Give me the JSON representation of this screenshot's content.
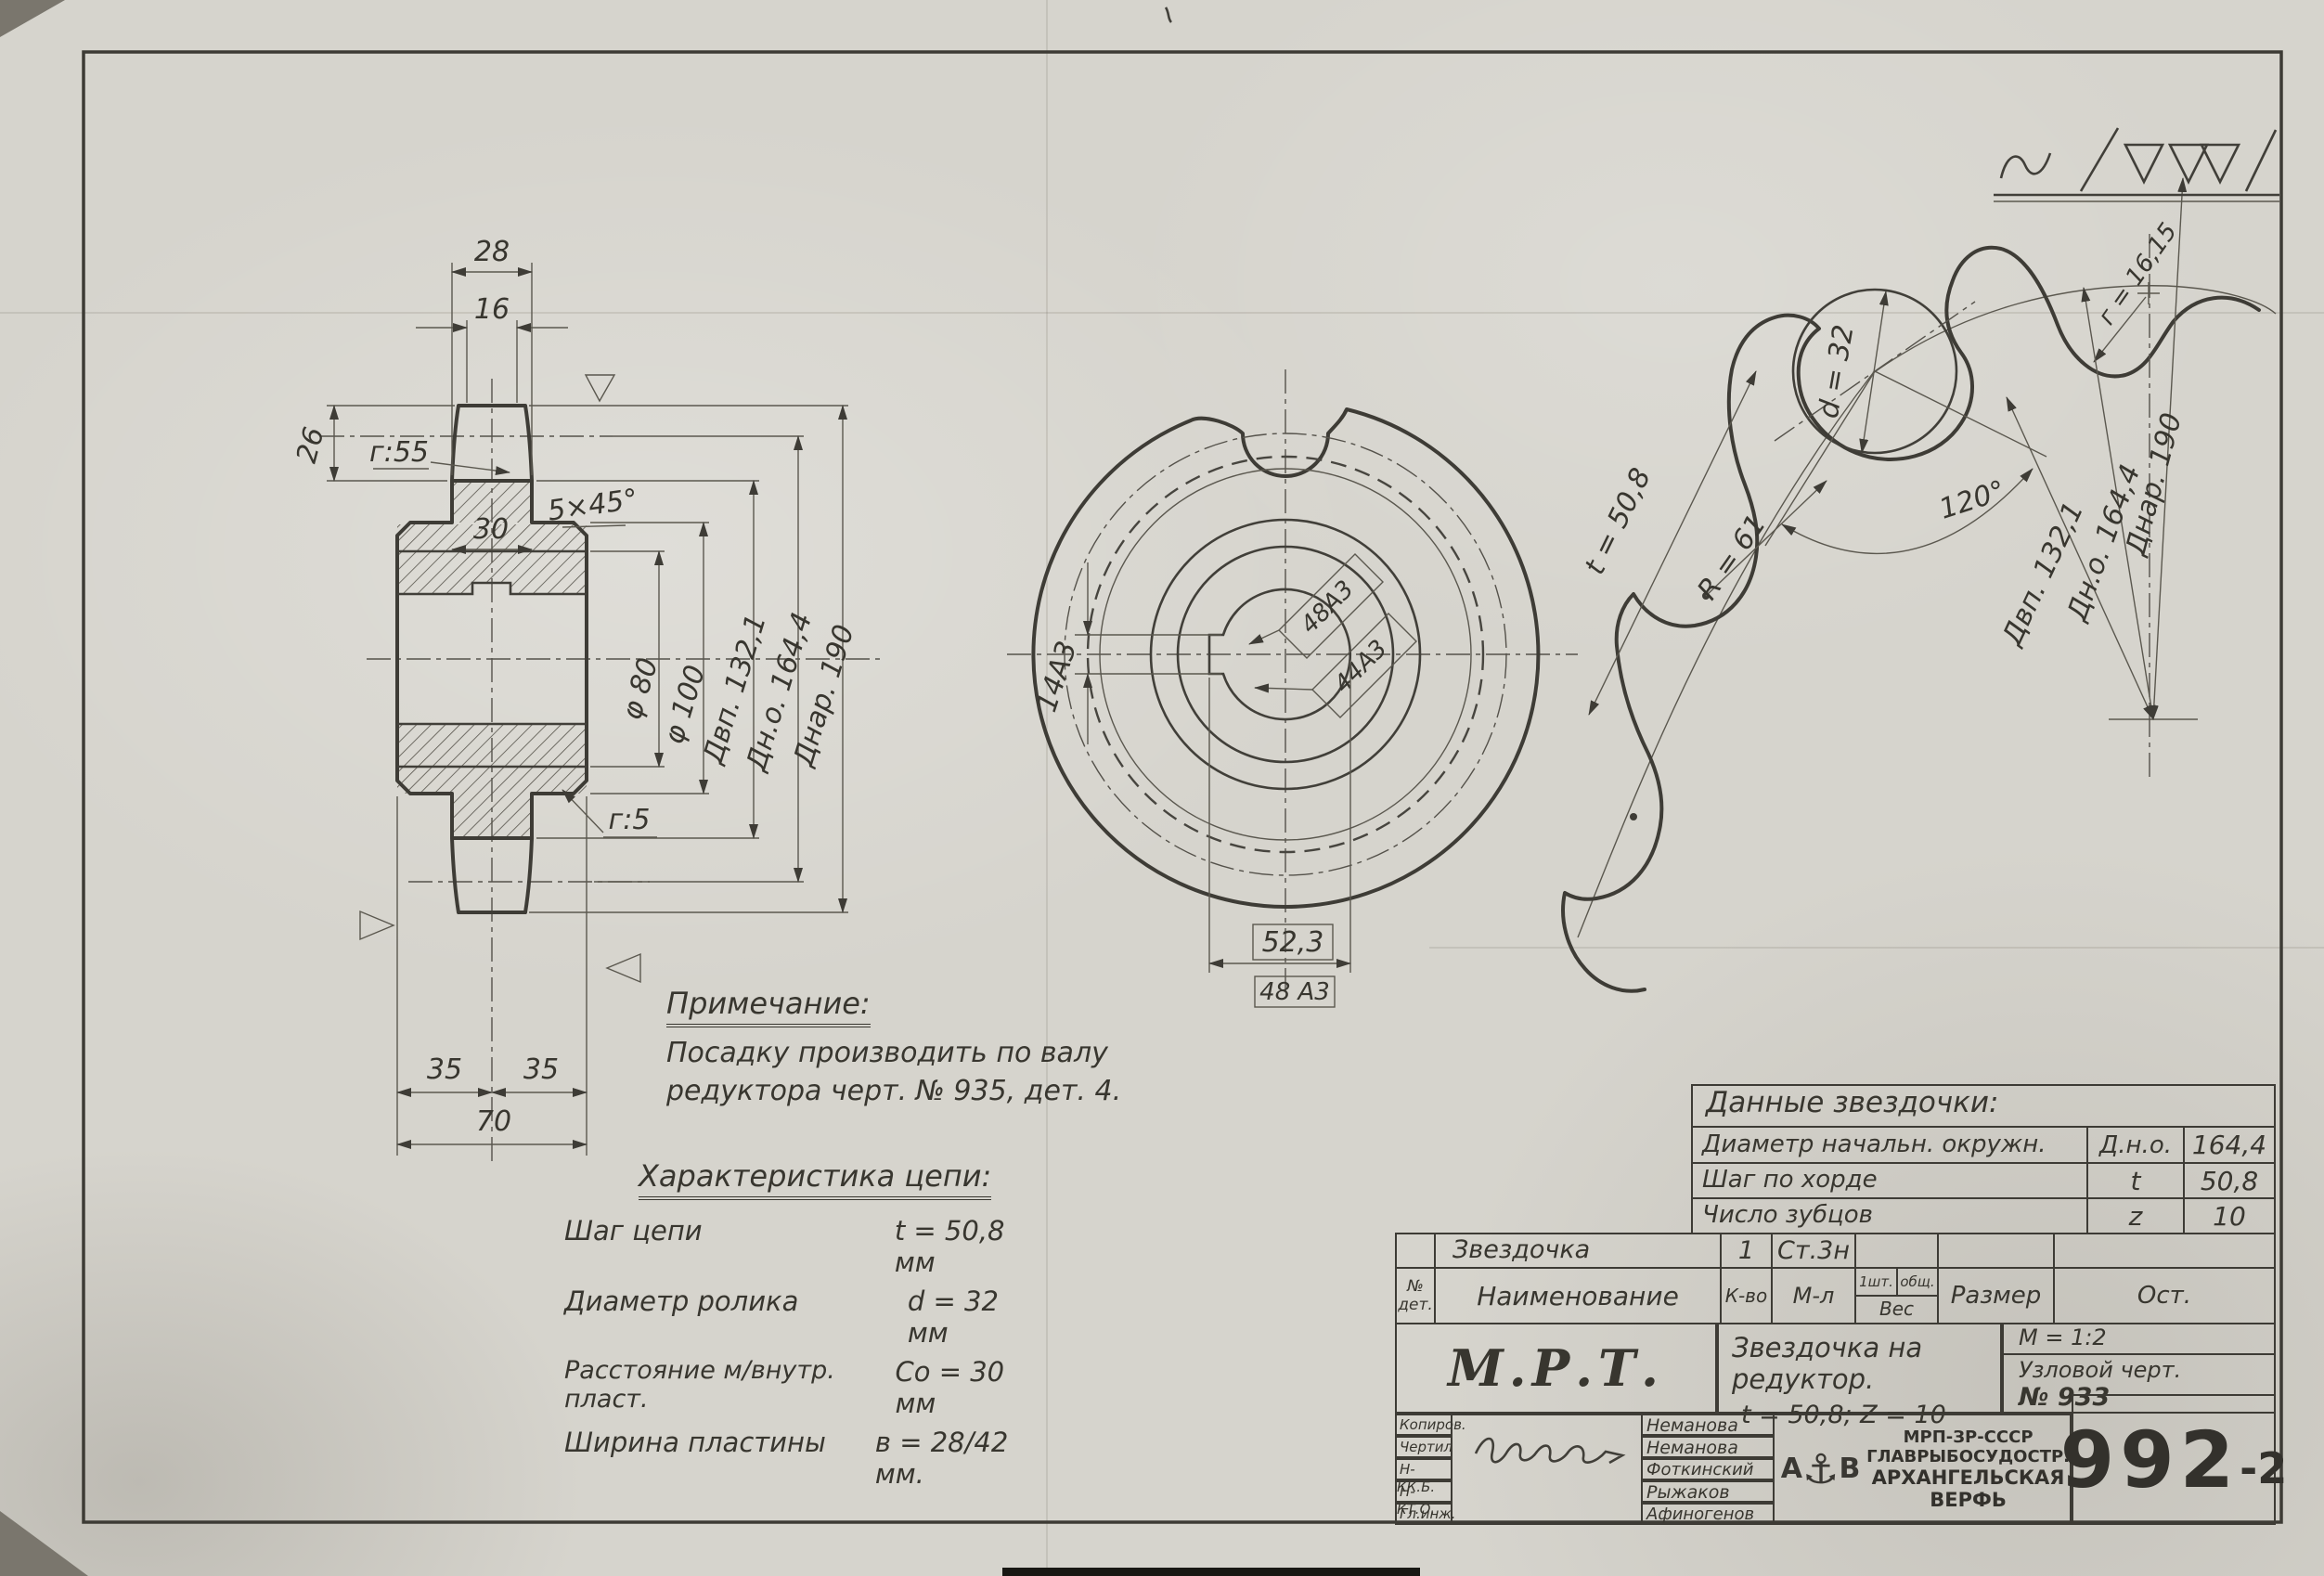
{
  "left_view": {
    "dim28": "28",
    "dim16": "16",
    "dim26": "26",
    "r55": "г:55",
    "dim30": "30",
    "chamfer": "5×45°",
    "d80": "φ 80",
    "d100": "φ 100",
    "dvp": "Двп. 132,1",
    "dno": "Дн.о. 164,4",
    "dnar": "Днар. 190",
    "r5": "г:5",
    "d35a": "35",
    "d35b": "35",
    "d70": "70"
  },
  "front_view": {
    "keyway_width": "14А3",
    "fit_upper": "48А3",
    "fit_lower": "44А3",
    "keyway_depth": "52,3",
    "bore_ref": "48 А3"
  },
  "detail_view": {
    "pitch": "t = 50,8",
    "roller": "d = 32",
    "flank_radius": "R = 61",
    "seat_angle": "120°",
    "root_radius": "г = 16,15",
    "dvp": "Двп. 132,1",
    "dno": "Дн.о. 164,4",
    "dnar": "Днар. 190"
  },
  "note": {
    "title": "Примечание:",
    "line1": "Посадку производить по валу",
    "line2": "редуктора  черт. № 935, дет. 4."
  },
  "chain_spec": {
    "title": "Характеристика цепи:",
    "rows": [
      {
        "name": "Шаг цепи",
        "value": "t = 50,8 мм"
      },
      {
        "name": "Диаметр ролика",
        "value": "d = 32 мм"
      },
      {
        "name": "Расстояние м/внутр. пласт.",
        "value": "Cо = 30 мм"
      },
      {
        "name": "Ширина пластины",
        "value": "в = 28/42 мм."
      }
    ]
  },
  "sprocket_table": {
    "title": "Данные  звездочки:",
    "rows": [
      {
        "name": "Диаметр начальн. окружн.",
        "symbol": "Д.н.о.",
        "value": "164,4"
      },
      {
        "name": "Шаг по хорде",
        "symbol": "t",
        "value": "50,8"
      },
      {
        "name": "Число зубцов",
        "symbol": "z",
        "value": "10"
      }
    ]
  },
  "parts_table": {
    "row": {
      "name": "Звездочка",
      "qty": "1",
      "material": "Ст.3н"
    },
    "headers": {
      "num1": "№",
      "num2": "дет.",
      "name": "Наименование",
      "qty": "К-во",
      "mat": "М-л",
      "w1": "1шт.",
      "w2": "общ.",
      "w3": "Вес",
      "size": "Размер",
      "rest": "Ост."
    }
  },
  "title_block": {
    "org_short": "М.Р.Т.",
    "title_line1": "Звездочка на редуктор.",
    "title_line2": "t = 50,8;  Z = 10",
    "scale": "М = 1:2",
    "node_ref1": "Узловой черт.",
    "node_ref2": "№ 933",
    "number_main": "992",
    "number_suffix": "-2",
    "sign_rows": [
      {
        "role": "Копиров.",
        "name": "Неманова"
      },
      {
        "role": "Чертил",
        "name": "Неманова"
      },
      {
        "role": "Н-КК.Б.",
        "name": "Фоткинский"
      },
      {
        "role": "Н-КТ.О.",
        "name": "Рыжаков"
      },
      {
        "role": "Гл.инж.",
        "name": "Афиногенов"
      }
    ],
    "org": {
      "line1": "МРП-ЗР-СССР",
      "line2": "ГЛАВРЫБОСУДОСТР.",
      "line3": "АРХАНГЕЛЬСКАЯ",
      "line4": "ВЕРФЬ",
      "logo_left": "А",
      "logo_anchor": "⚓",
      "logo_right": "В"
    }
  }
}
